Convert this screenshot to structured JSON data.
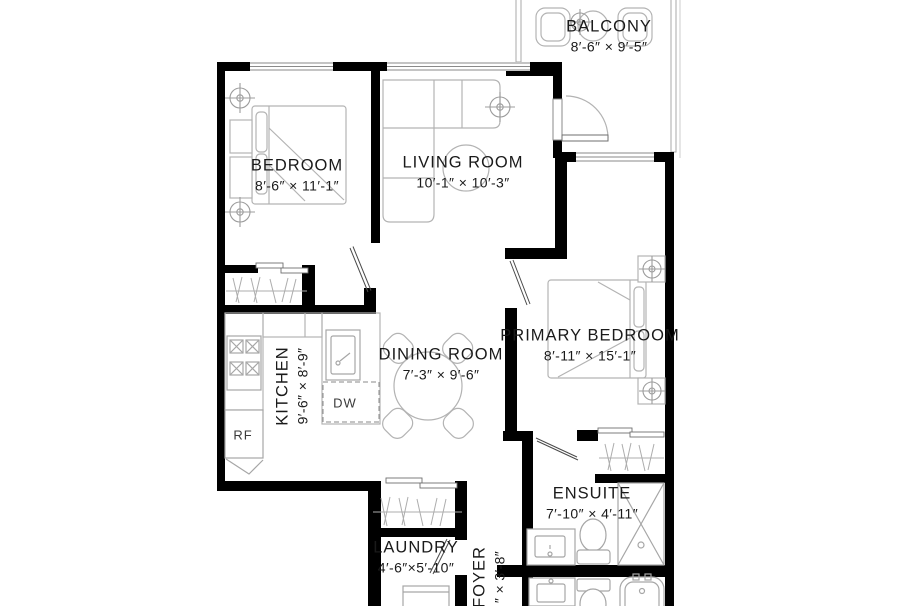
{
  "plan": {
    "background": "#ffffff",
    "wall_color": "#000000",
    "furniture_line_color": "#b3b3b3",
    "text_color": "#1a1a1a",
    "rooms": [
      {
        "name": "BALCONY",
        "dimensions": "8′-6″  ×  9′-5″"
      },
      {
        "name": "BEDROOM",
        "dimensions": "8′-6″  ×  11′-1″"
      },
      {
        "name": "LIVING ROOM",
        "dimensions": "10′-1″  ×  10′-3″"
      },
      {
        "name": "PRIMARY BEDROOM",
        "dimensions": "8′-11″  ×  15′-1″"
      },
      {
        "name": "KITCHEN",
        "dimensions": "9′-6″  ×  8′-9″"
      },
      {
        "name": "DINING ROOM",
        "dimensions": "7′-3″  ×  9′-6″"
      },
      {
        "name": "ENSUITE",
        "dimensions": "7′-10″  ×  4′-11″"
      },
      {
        "name": "LAUNDRY",
        "dimensions": "4′-6″×5′-10″"
      },
      {
        "name": "FOYER",
        "dimensions": "″ ×  3′-8″"
      }
    ],
    "appliances": {
      "dishwasher": "DW",
      "refrigerator": "RF"
    }
  }
}
